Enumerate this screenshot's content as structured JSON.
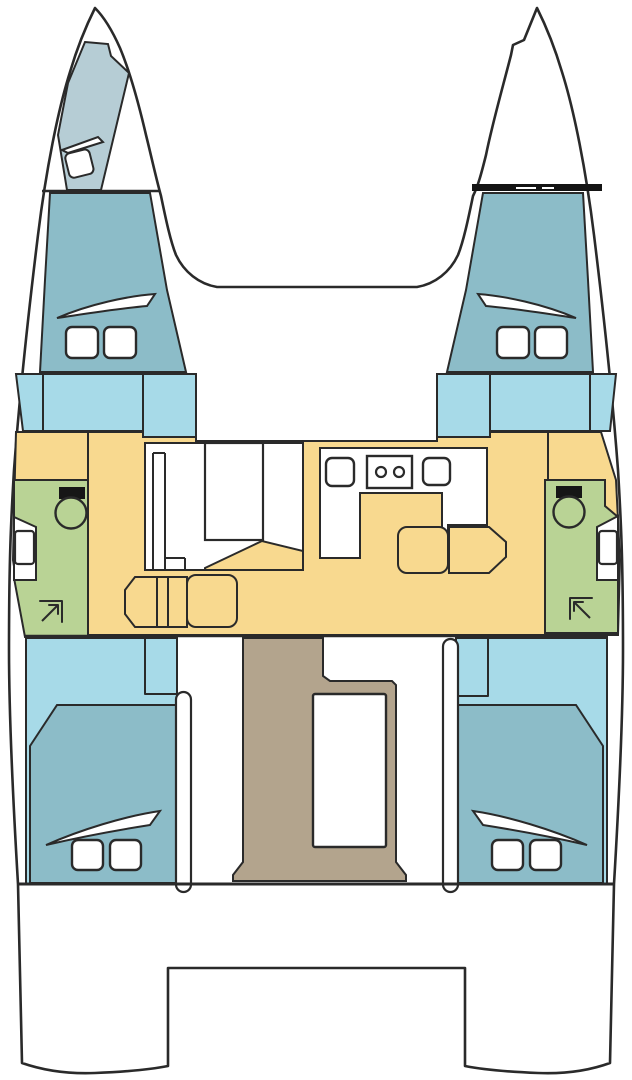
{
  "diagram": {
    "type": "catamaran-deck-plan",
    "view": "top-down",
    "description": "Interior layout plan of a twin-hull sailing catamaran with 4 cabins, 2 heads, central saloon with galley, and aft cockpit",
    "hull_count": 2
  },
  "colors": {
    "outline": "#2a2a2a",
    "cabin_teal": "#8cbcc8",
    "deck_blue": "#a7dae8",
    "forepeak_gray": "#b6cdd5",
    "saloon_yellow": "#f8d98f",
    "head_green": "#b9d395",
    "cockpit_tan": "#b3a48d",
    "crossbar_black": "#141414",
    "fixture_white": "#ffffff"
  },
  "areas": {
    "port_forepeak": {
      "label": "Port forepeak locker",
      "color": "forepeak_gray"
    },
    "port_forward_cabin": {
      "label": "Port forward cabin",
      "color": "cabin_teal"
    },
    "starboard_forward_cabin": {
      "label": "Starboard forward cabin",
      "color": "cabin_teal"
    },
    "port_side_deck": {
      "label": "Port side deck step",
      "color": "deck_blue"
    },
    "starboard_side_deck": {
      "label": "Starboard side deck step",
      "color": "deck_blue"
    },
    "saloon": {
      "label": "Saloon and galley sole",
      "color": "saloon_yellow"
    },
    "port_head": {
      "label": "Port head with shower",
      "color": "head_green"
    },
    "starboard_head": {
      "label": "Starboard head with shower",
      "color": "head_green"
    },
    "port_aft_cabin": {
      "label": "Port aft cabin",
      "color": "cabin_teal"
    },
    "starboard_aft_cabin": {
      "label": "Starboard aft cabin",
      "color": "cabin_teal"
    },
    "cockpit": {
      "label": "Aft cockpit",
      "color": "cockpit_tan"
    }
  },
  "fixtures": {
    "toilets": 2,
    "sinks": 2,
    "stove_burners": 2,
    "deck_hatches": 8,
    "hull_windows": 4,
    "sliding_doors": 2,
    "cockpit_table": 1,
    "saloon_table": 1
  }
}
